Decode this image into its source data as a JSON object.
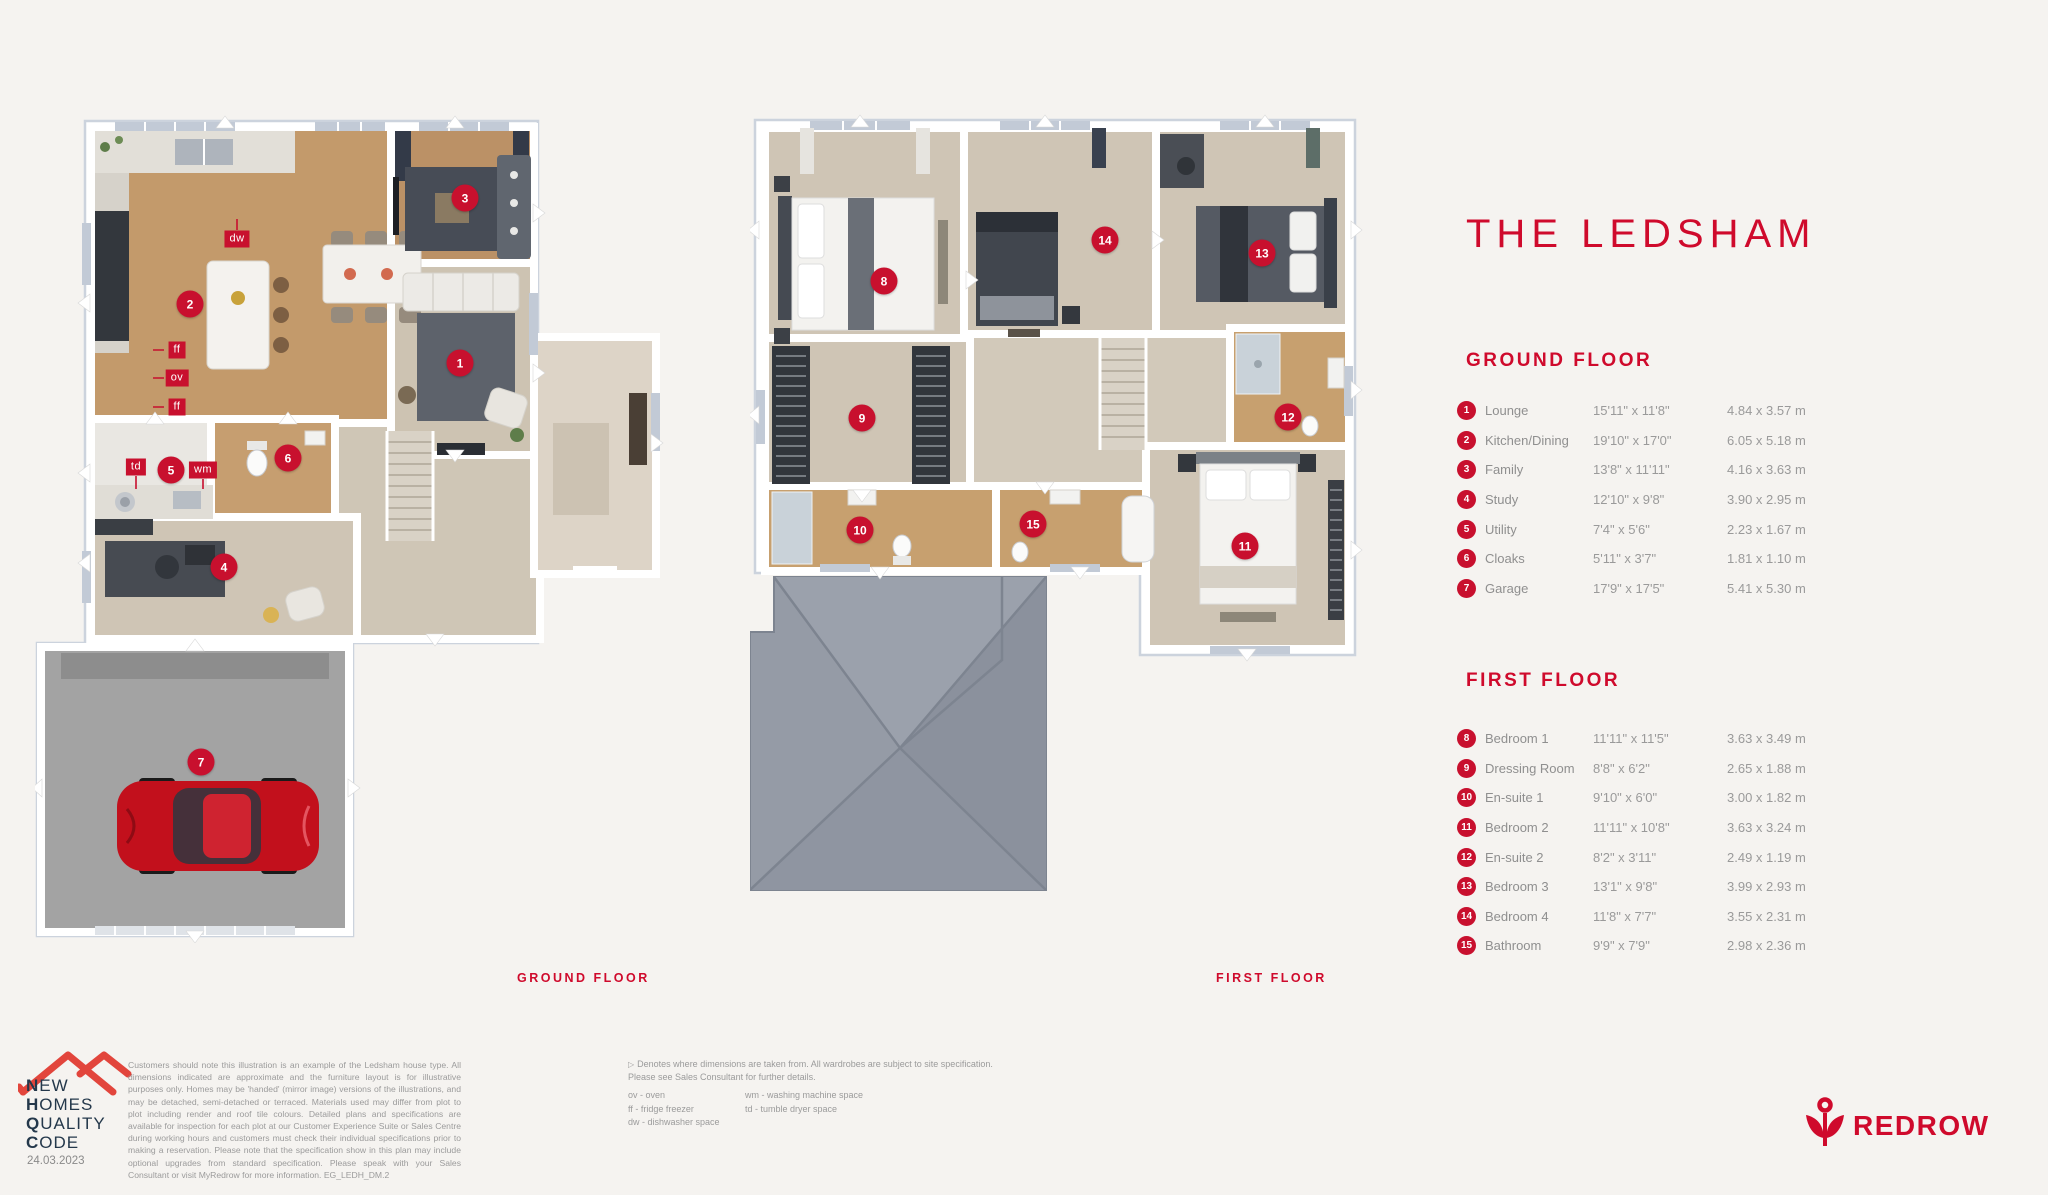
{
  "page": {
    "bg": "#f5f3f0",
    "accent_red": "#cf0a2c",
    "marker_red": "#c8102e",
    "nhqc_navy": "#24384b"
  },
  "title": "THE LEDSHAM",
  "plans": {
    "ground_caption": "GROUND FLOOR",
    "first_caption": "FIRST FLOOR"
  },
  "ground_floor": {
    "heading": "GROUND FLOOR",
    "rooms": [
      {
        "num": "1",
        "name": "Lounge",
        "imperial": "15'11\" x 11'8\"",
        "metric": "4.84 x 3.57 m"
      },
      {
        "num": "2",
        "name": "Kitchen/Dining",
        "imperial": "19'10\" x 17'0\"",
        "metric": "6.05 x 5.18 m"
      },
      {
        "num": "3",
        "name": "Family",
        "imperial": "13'8\" x 11'11\"",
        "metric": "4.16 x 3.63 m"
      },
      {
        "num": "4",
        "name": "Study",
        "imperial": "12'10\" x 9'8\"",
        "metric": "3.90 x 2.95 m"
      },
      {
        "num": "5",
        "name": "Utility",
        "imperial": "7'4\" x 5'6\"",
        "metric": "2.23 x 1.67 m"
      },
      {
        "num": "6",
        "name": "Cloaks",
        "imperial": "5'11\" x 3'7\"",
        "metric": "1.81 x 1.10 m"
      },
      {
        "num": "7",
        "name": "Garage",
        "imperial": "17'9\" x 17'5\"",
        "metric": "5.41 x 5.30 m"
      }
    ]
  },
  "first_floor": {
    "heading": "FIRST FLOOR",
    "rooms": [
      {
        "num": "8",
        "name": "Bedroom 1",
        "imperial": "11'11\" x 11'5\"",
        "metric": "3.63 x 3.49 m"
      },
      {
        "num": "9",
        "name": "Dressing Room",
        "imperial": "8'8\" x 6'2\"",
        "metric": "2.65 x 1.88 m"
      },
      {
        "num": "10",
        "name": "En-suite 1",
        "imperial": "9'10\" x 6'0\"",
        "metric": "3.00 x 1.82 m"
      },
      {
        "num": "11",
        "name": "Bedroom 2",
        "imperial": "11'11\" x 10'8\"",
        "metric": "3.63 x 3.24 m"
      },
      {
        "num": "12",
        "name": "En-suite 2",
        "imperial": "8'2\" x 3'11\"",
        "metric": "2.49 x 1.19 m"
      },
      {
        "num": "13",
        "name": "Bedroom 3",
        "imperial": "13'1\" x 9'8\"",
        "metric": "3.99 x 2.93 m"
      },
      {
        "num": "14",
        "name": "Bedroom 4",
        "imperial": "11'8\" x 7'7\"",
        "metric": "3.55 x 2.31 m"
      },
      {
        "num": "15",
        "name": "Bathroom",
        "imperial": "9'9\" x 7'9\"",
        "metric": "2.98 x 2.36 m"
      }
    ]
  },
  "plan_markers": {
    "ground": [
      {
        "n": "2",
        "x": 155,
        "y": 211
      },
      {
        "n": "3",
        "x": 430,
        "y": 105
      },
      {
        "n": "1",
        "x": 425,
        "y": 270
      },
      {
        "n": "5",
        "x": 136,
        "y": 377
      },
      {
        "n": "6",
        "x": 253,
        "y": 365
      },
      {
        "n": "4",
        "x": 189,
        "y": 474
      },
      {
        "n": "7",
        "x": 166,
        "y": 669
      }
    ],
    "first": [
      {
        "n": "8",
        "x": 134,
        "y": 181
      },
      {
        "n": "14",
        "x": 355,
        "y": 140
      },
      {
        "n": "13",
        "x": 512,
        "y": 153
      },
      {
        "n": "9",
        "x": 112,
        "y": 318
      },
      {
        "n": "10",
        "x": 110,
        "y": 430
      },
      {
        "n": "15",
        "x": 283,
        "y": 424
      },
      {
        "n": "12",
        "x": 538,
        "y": 317
      },
      {
        "n": "11",
        "x": 495,
        "y": 446
      }
    ]
  },
  "appliance_labels": [
    {
      "t": "dw",
      "x": 202,
      "y": 146
    },
    {
      "t": "ff",
      "x": 142,
      "y": 257
    },
    {
      "t": "ov",
      "x": 142,
      "y": 285
    },
    {
      "t": "ff",
      "x": 142,
      "y": 314
    },
    {
      "t": "td",
      "x": 101,
      "y": 374
    },
    {
      "t": "wm",
      "x": 168,
      "y": 377
    }
  ],
  "footer": {
    "nhqc_lines": [
      {
        "b": "N",
        "r": "EW"
      },
      {
        "b": "H",
        "r": "OMES"
      },
      {
        "b": "Q",
        "r": "UALITY"
      },
      {
        "b": "C",
        "r": "ODE"
      }
    ],
    "date": "24.03.2023",
    "disclaimer": "Customers should note this illustration is an example of the Ledsham house type. All dimensions indicated are approximate and the furniture layout is for illustrative purposes only. Homes may be 'handed' (mirror image) versions of the illustrations, and may be detached, semi-detached or terraced. Materials used may differ from plot to plot including render and roof tile colours. Detailed plans and specifications are available for inspection for each plot at our Customer Experience Suite or Sales Centre during working hours and customers must check their individual specifications prior to making a reservation. Please note that the specification show in this plan may include optional upgrades from standard specification. Please speak with your Sales Consultant or visit MyRedrow for more information. EG_LEDH_DM.2",
    "note_line1": "Denotes where dimensions are taken from. All wardrobes are subject to site specification.",
    "note_line2": "Please see Sales Consultant for further details.",
    "legend_col1": [
      "ov - oven",
      "ff - fridge freezer",
      "dw - dishwasher space"
    ],
    "legend_col2": [
      "wm - washing machine space",
      "td - tumble dryer space"
    ],
    "redrow": "REDROW"
  }
}
